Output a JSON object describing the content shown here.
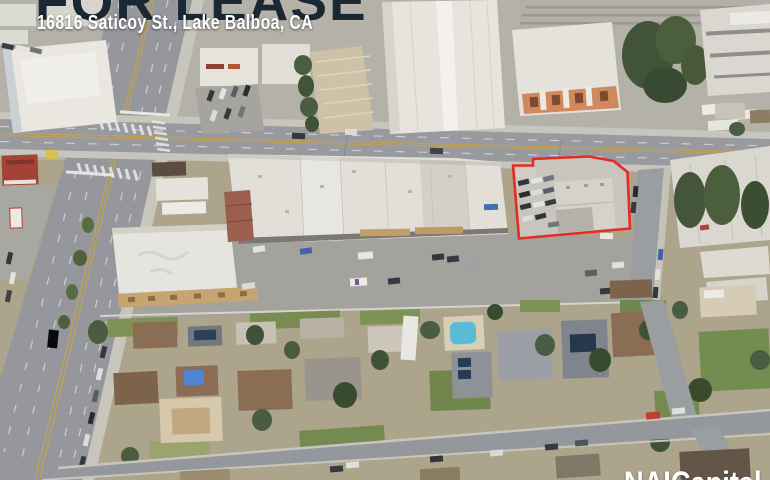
{
  "header": {
    "title": "FOR LEASE",
    "address": "16816 Saticoy St., Lake Balboa, CA",
    "title_color": "#1b2733",
    "address_color": "#ffffff"
  },
  "map": {
    "type": "aerial-photo",
    "subject": "Commercial parcel on Saticoy St. outlined in red",
    "outline_color": "#e8241e"
  },
  "branding": {
    "logo_text": "NAICapital",
    "logo_color": "#ffffff"
  }
}
